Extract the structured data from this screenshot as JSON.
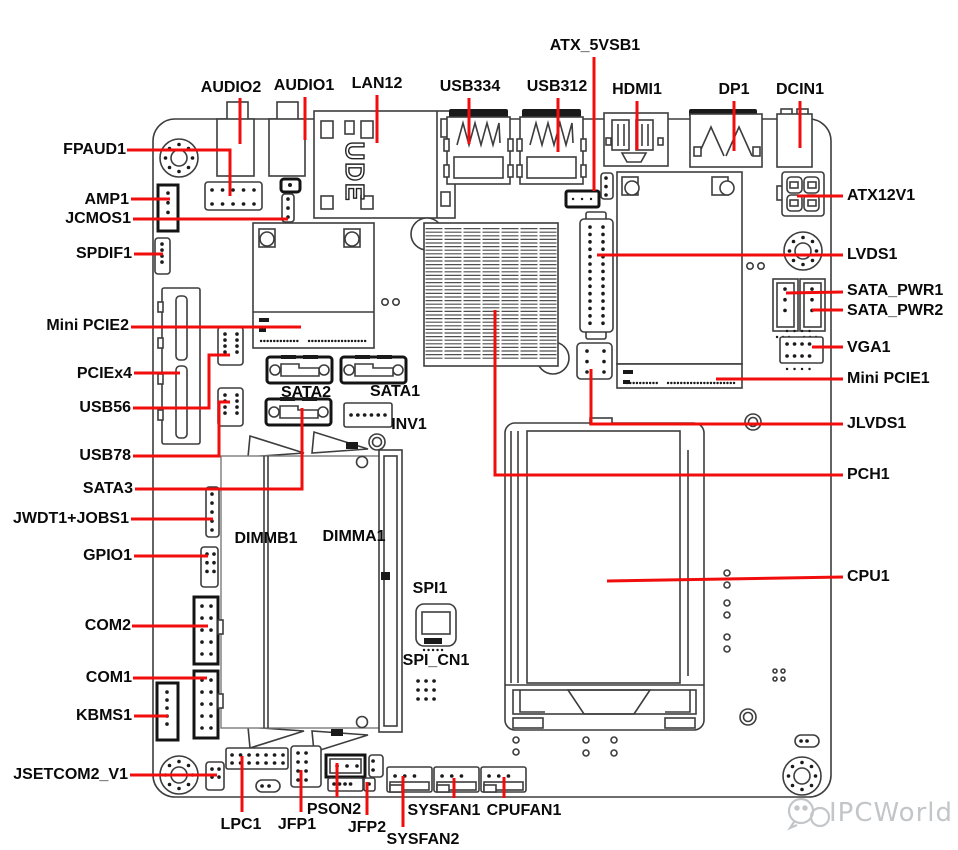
{
  "labels": {
    "atx_5vsb1": "ATX_5VSB1",
    "audio2": "AUDIO2",
    "audio1": "AUDIO1",
    "lan12": "LAN12",
    "usb334": "USB334",
    "usb312": "USB312",
    "hdmi1": "HDMI1",
    "dp1": "DP1",
    "dcin1": "DCIN1",
    "atx12v1": "ATX12V1",
    "lvds1": "LVDS1",
    "sata_pwr1": "SATA_PWR1",
    "sata_pwr2": "SATA_PWR2",
    "vga1": "VGA1",
    "mini_pcie1": "Mini PCIE1",
    "jlvds1": "JLVDS1",
    "pch1": "PCH1",
    "cpu1": "CPU1",
    "fpaud1": "FPAUD1",
    "amp1": "AMP1",
    "jcmos1": "JCMOS1",
    "spdif1": "SPDIF1",
    "mini_pcie2": "Mini PCIE2",
    "pciex4": "PCIEx4",
    "usb56": "USB56",
    "usb78": "USB78",
    "sata3": "SATA3",
    "jwdt1_jobs1": "JWDT1+JOBS1",
    "gpio1": "GPIO1",
    "com2": "COM2",
    "com1": "COM1",
    "kbms1": "KBMS1",
    "jsetcom2_v1": "JSETCOM2_V1",
    "lpc1": "LPC1",
    "jfp1": "JFP1",
    "pson2": "PSON2",
    "jfp2": "JFP2",
    "sysfan2": "SYSFAN2",
    "sysfan1": "SYSFAN1",
    "cpufan1": "CPUFAN1",
    "sata2": "SATA2",
    "sata1": "SATA1",
    "inv1": "INV1",
    "dimmb1": "DIMMB1",
    "dimma1": "DIMMA1",
    "spi1": "SPI1",
    "spi_cn1": "SPI_CN1"
  },
  "board": {
    "lan_marking": "UDE"
  },
  "watermark": {
    "brand": "IPCWorld"
  },
  "colors": {
    "leader_line": "#f20d0d",
    "label_text": "#0a0a0a",
    "drawing_outline": "#3d3d3d",
    "watermark": "#c3c6c9",
    "background": "#ffffff"
  }
}
